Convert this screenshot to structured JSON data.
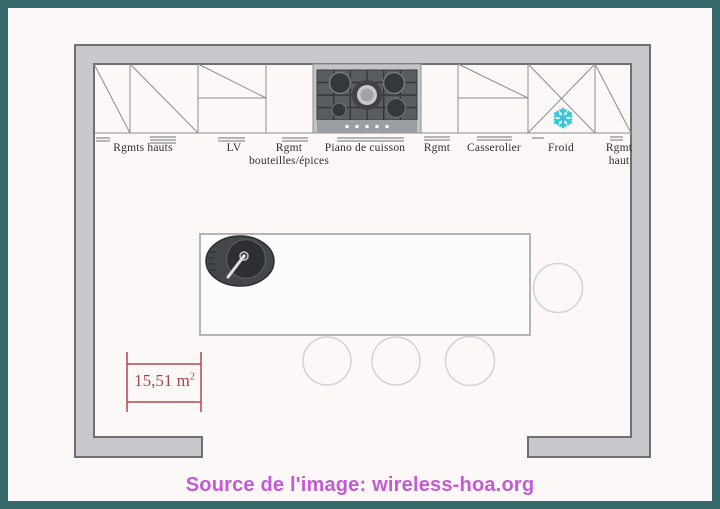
{
  "page": {
    "type": "kitchen floor plan image",
    "background_color": "#fbf8f7",
    "frame_color": "#35696c",
    "caption": "Source de l'image: wireless-hoa.org",
    "caption_color": "#c45ad6"
  },
  "plan": {
    "wall_fill_color": "#c9c8cd",
    "wall_stroke_color": "#6f6f74",
    "area": {
      "value": "15,51 m",
      "sup": "2",
      "color": "#a8444b"
    },
    "froid_icon": {
      "name": "snowflake",
      "color": "#35c8da"
    },
    "labels": [
      {
        "id": "rgmts-hauts",
        "line1": "Rgmts hauts",
        "line2": ""
      },
      {
        "id": "lv",
        "line1": "LV",
        "line2": ""
      },
      {
        "id": "rgmt-bouteilles-epices",
        "line1": "Rgmt",
        "line2": "bouteilles/épices"
      },
      {
        "id": "piano-de-cuisson",
        "line1": "Piano de cuisson",
        "line2": ""
      },
      {
        "id": "rgmt",
        "line1": "Rgmt",
        "line2": ""
      },
      {
        "id": "casserolier",
        "line1": "Casserolier",
        "line2": ""
      },
      {
        "id": "froid",
        "line1": "Froid",
        "line2": ""
      },
      {
        "id": "rgmt-haut",
        "line1": "Rgmt",
        "line2": "haut"
      }
    ]
  }
}
